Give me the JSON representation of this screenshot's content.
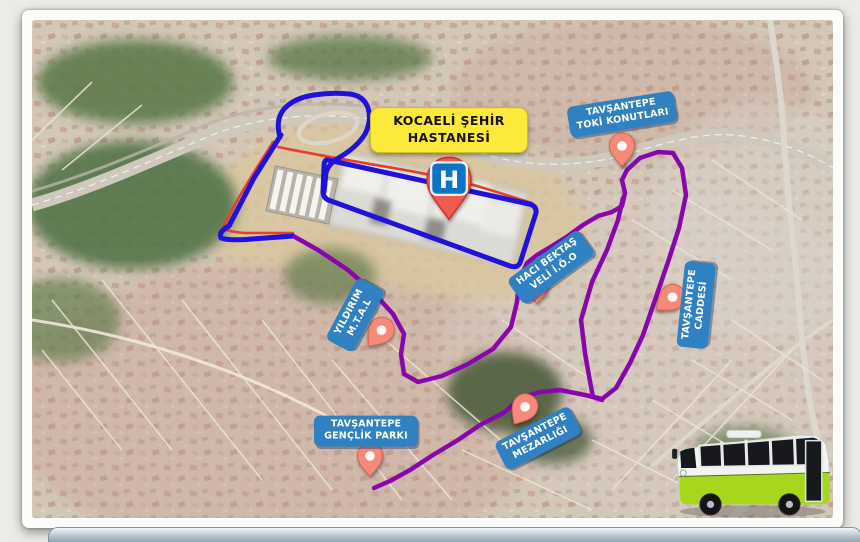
{
  "map": {
    "title": "KOCAELİ ŞEHİR HASTANESİ",
    "hospital_marker": "H",
    "labels": {
      "toki": "TAVŞANTEPE TOKİ KONUTLARI",
      "haci_bektas": "HACI BEKTAŞ VELİ İ.Ö.O",
      "yildirim": "YILDIRIM M.T.A.L",
      "caddesi": "TAVŞANTEPE CADDESİ",
      "mezarligi": "TAVŞANTEPE MEZARLIĞI",
      "genclik": "TAVŞANTEPE GENÇLİK PARKI"
    },
    "colors": {
      "title_bg": "#fde93a",
      "label_bg": "#2f81c2",
      "pin": "#f58a7a",
      "pin_hospital": "#f05a50",
      "hospital_icon_bg": "#0d74c4",
      "route_blue": "#2012d8",
      "route_purple": "#8707ad",
      "route_red": "#e6402c",
      "bus_green": "#a6d71d"
    }
  }
}
